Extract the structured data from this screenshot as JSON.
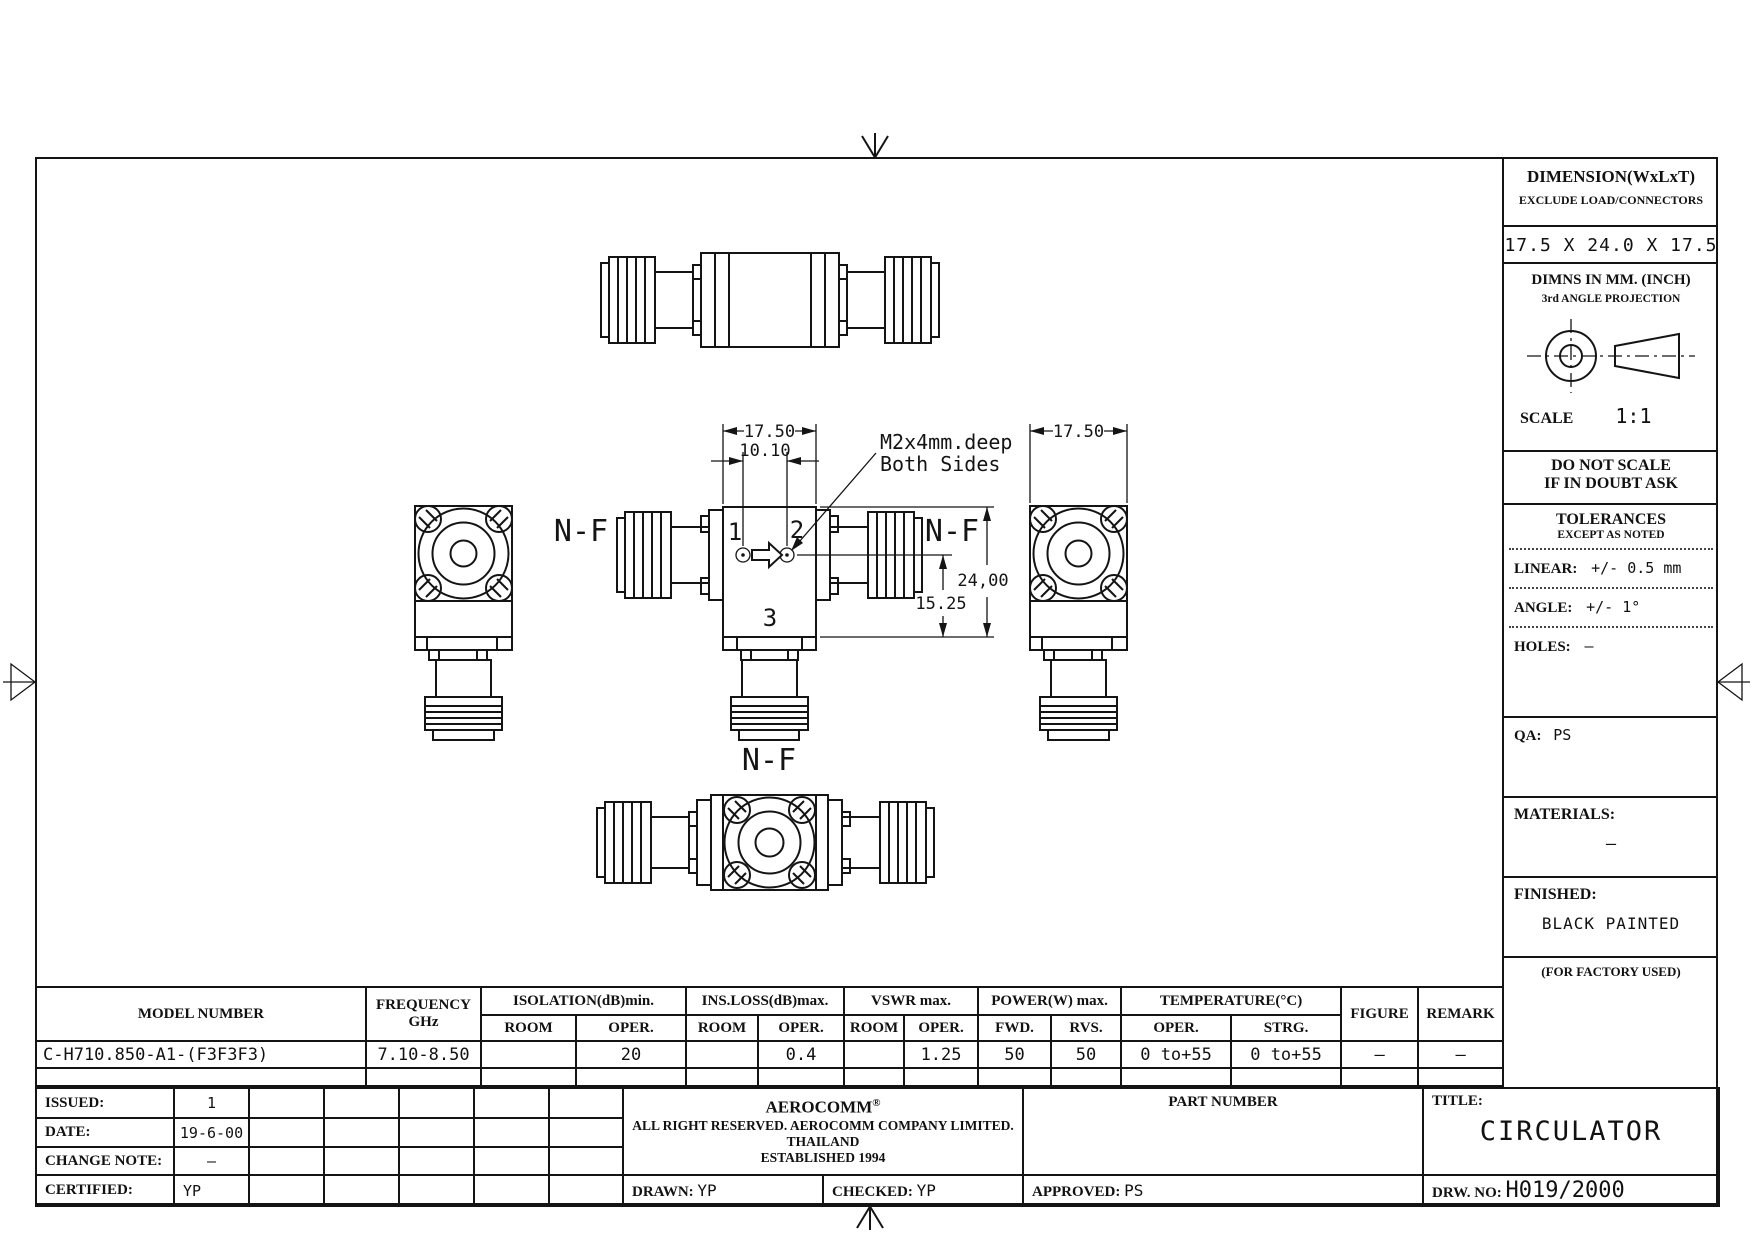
{
  "right_panel": {
    "dimension_header": "DIMENSION(WxLxT)",
    "dimension_sub": "EXCLUDE LOAD/CONNECTORS",
    "dimension_value": "17.5 X 24.0 X 17.5",
    "dimns_line1": "DIMNS IN MM. (INCH)",
    "dimns_line2": "3rd ANGLE PROJECTION",
    "scale_label": "SCALE",
    "scale_value": "1:1",
    "do_not_scale_line1": "DO NOT SCALE",
    "do_not_scale_line2": "IF IN DOUBT ASK",
    "tolerances_title": "TOLERANCES",
    "tolerances_sub": "EXCEPT AS NOTED",
    "linear_label": "LINEAR:",
    "linear_value": "+/- 0.5 mm",
    "angle_label": "ANGLE:",
    "angle_value": "+/- 1°",
    "holes_label": "HOLES:",
    "holes_value": "—",
    "qa_label": "QA:",
    "qa_value": "PS",
    "materials_label": "MATERIALS:",
    "materials_value": "—",
    "finished_label": "FINISHED:",
    "finished_value": "BLACK PAINTED",
    "factory_note": "(FOR FACTORY USED)"
  },
  "drawing": {
    "top_dim": "17.50",
    "holes_dim": "10.10",
    "side_dim": "17.50",
    "height_dim": "24,00",
    "port_height_dim": "15.25",
    "note_line1": "M2x4mm.deep",
    "note_line2": "Both Sides",
    "port1": "1",
    "port2": "2",
    "port3": "3",
    "nf_left": "N-F",
    "nf_right": "N-F",
    "nf_bottom": "N-F"
  },
  "spec_table": {
    "model_header": "MODEL NUMBER",
    "frequency_header": "FREQUENCY",
    "frequency_unit": "GHz",
    "isolation_header": "ISOLATION(dB)min.",
    "ins_loss_header": "INS.LOSS(dB)max.",
    "vswr_header": "VSWR max.",
    "power_header": "POWER(W) max.",
    "temperature_header": "TEMPERATURE(°C)",
    "figure_header": "FIGURE",
    "remark_header": "REMARK",
    "subheaders": [
      "ROOM",
      "OPER.",
      "ROOM",
      "OPER.",
      "ROOM",
      "OPER.",
      "FWD.",
      "RVS.",
      "OPER.",
      "STRG."
    ],
    "row": {
      "model": "C-H710.850-A1-(F3F3F3)",
      "frequency": "7.10-8.50",
      "isolation_room": "",
      "isolation_oper": "20",
      "ins_loss_room": "",
      "ins_loss_oper": "0.4",
      "vswr_room": "",
      "vswr_oper": "1.25",
      "power_fwd": "50",
      "power_rvs": "50",
      "temp_oper": "0 to+55",
      "temp_strg": "0 to+55",
      "figure": "—",
      "remark": "—"
    }
  },
  "title_block": {
    "issued_label": "ISSUED:",
    "issued_value": "1",
    "date_label": "DATE:",
    "date_value": "19-6-00",
    "change_note_label": "CHANGE NOTE:",
    "change_note_value": "–",
    "certified_label": "CERTIFIED:",
    "certified_value": "YP",
    "company_name": "AEROCOMM",
    "company_reg": "®",
    "company_line1": "ALL RIGHT RESERVED.  AEROCOMM COMPANY LIMITED.  THAILAND",
    "company_line2": "ESTABLISHED 1994",
    "drawn_label": "DRAWN:",
    "drawn_value": "YP",
    "checked_label": "CHECKED:",
    "checked_value": "YP",
    "approved_label": "APPROVED:",
    "approved_value": "PS",
    "part_number_label": "PART NUMBER",
    "title_label": "TITLE:",
    "title_value": "CIRCULATOR",
    "drw_no_label": "DRW. NO:",
    "drw_no_value": "H019/2000"
  }
}
